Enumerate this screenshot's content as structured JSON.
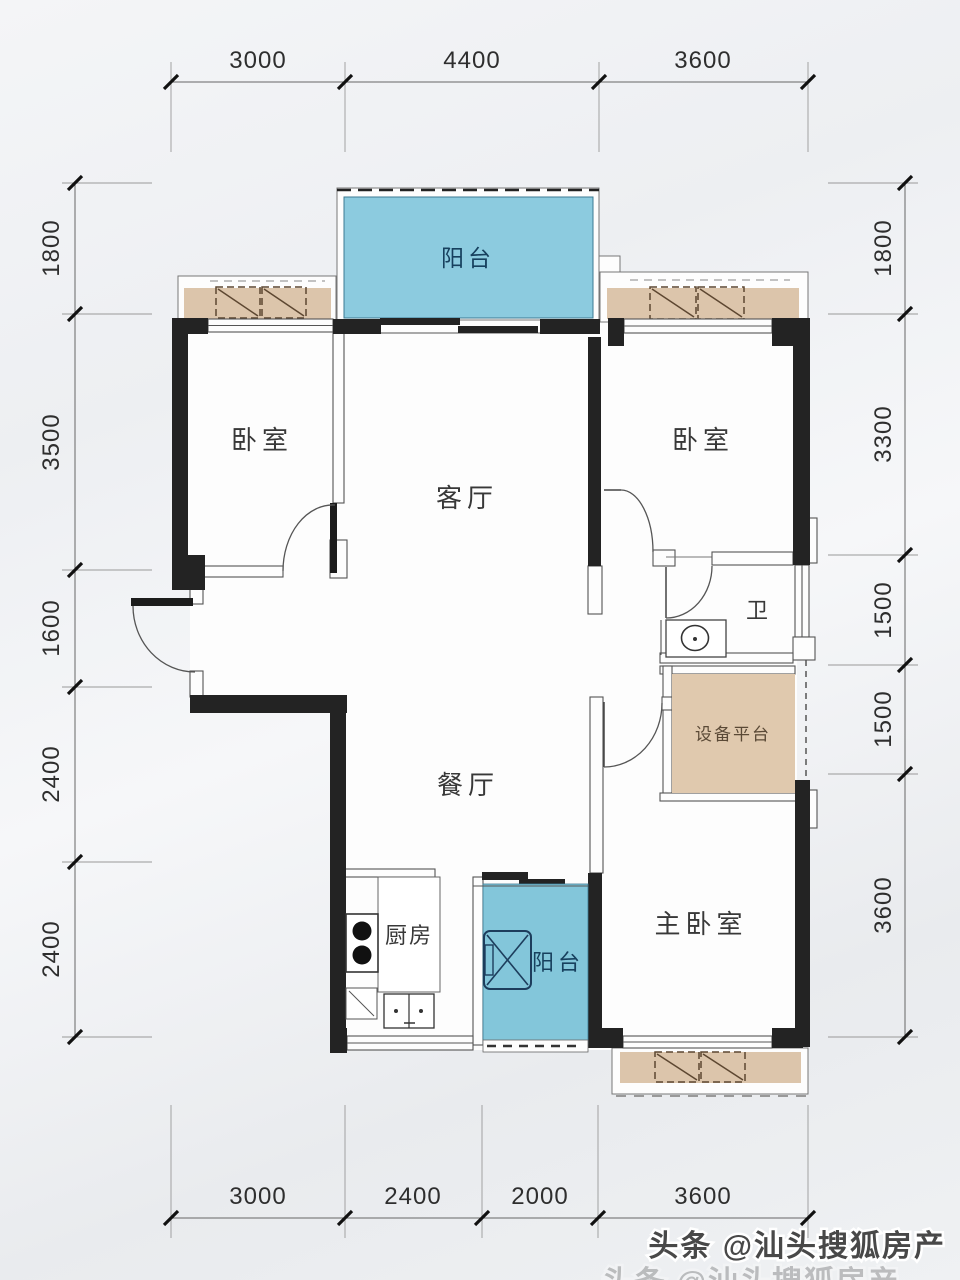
{
  "rooms": {
    "balcony_top": "阳台",
    "bedroom_left": "卧室",
    "living_room": "客厅",
    "bedroom_right": "卧室",
    "bathroom": "卫",
    "equipment_platform": "设备平台",
    "dining_room": "餐厅",
    "kitchen": "厨房",
    "balcony_bottom": "阳台",
    "master_bedroom": "主卧室"
  },
  "dimensions": {
    "top": [
      "3000",
      "4400",
      "3600"
    ],
    "bottom": [
      "3000",
      "2400",
      "2000",
      "3600"
    ],
    "left": [
      "1800",
      "3500",
      "1600",
      "2400",
      "2400"
    ],
    "right": [
      "1800",
      "3300",
      "1500",
      "1500",
      "3600"
    ]
  },
  "watermark": {
    "text": "头条 @汕头搜狐房产"
  },
  "colors": {
    "balcony_blue": "#8ccbdf",
    "bay_window_tan": "#dcc5ab",
    "platform_tan": "#e0c9ae",
    "wall_black": "#232323",
    "balcony_label_navy": "#17405e",
    "dimension_text": "#2e2e2e"
  }
}
